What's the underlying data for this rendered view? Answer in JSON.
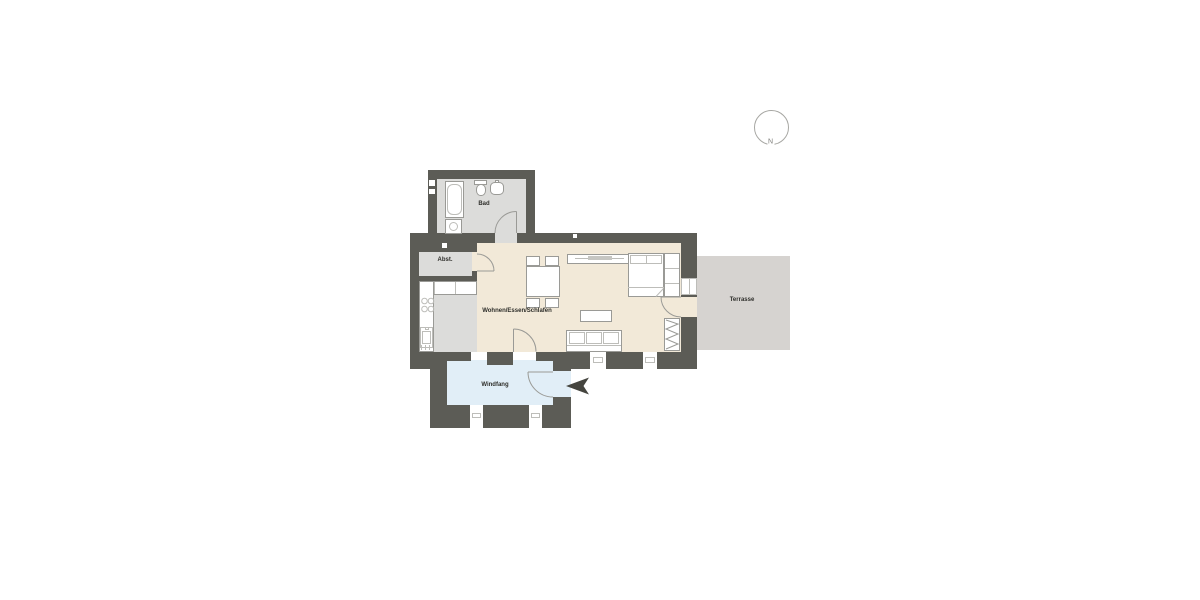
{
  "compass": {
    "label": "N"
  },
  "rooms": {
    "bad": {
      "label": "Bad"
    },
    "abst": {
      "label": "Abst."
    },
    "wohnen_essen_schlafen": {
      "label": "Wohnen/Essen/Schlafen"
    },
    "windfang": {
      "label": "Windfang"
    },
    "terrasse": {
      "label": "Terrasse"
    }
  },
  "colors": {
    "wall": "#5c5c56",
    "floor-main": "#f2e9d8",
    "floor-bad": "#dcdcda",
    "floor-windfang": "#e1eef7",
    "floor-terrace": "#d6d3d0",
    "arrow": "#45453f",
    "line": "#9a9a96",
    "label": "#2e2e2a"
  }
}
